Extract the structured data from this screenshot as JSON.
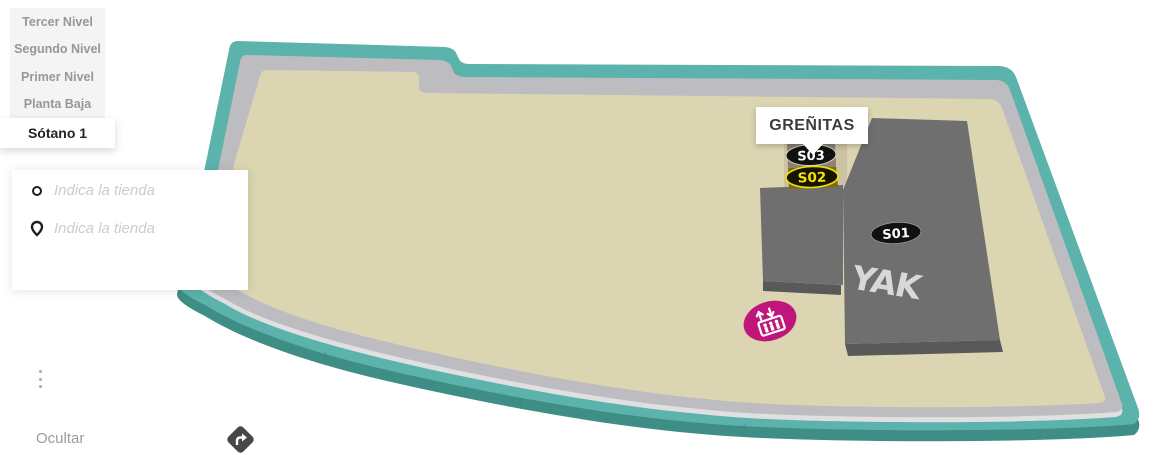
{
  "levels": {
    "items": [
      {
        "label": "Tercer Nivel"
      },
      {
        "label": "Segundo Nivel"
      },
      {
        "label": "Primer Nivel"
      },
      {
        "label": "Planta Baja"
      }
    ],
    "selected": {
      "label": "Sótano 1"
    }
  },
  "legend": {
    "origin_placeholder": "Indica la tienda",
    "destination_placeholder": "Indica la tienda",
    "hide_label": "Ocultar"
  },
  "map": {
    "bubble_label": "GREÑITAS",
    "stores": {
      "s01": {
        "id": "S01",
        "logo": "YAK"
      },
      "s02": {
        "id": "S02"
      },
      "s03": {
        "id": "S03"
      }
    },
    "icons": {
      "elevator": "elevator-icon",
      "directions": "directions-arrow-icon"
    },
    "colors": {
      "outline": "#5CB3AC",
      "outline_side": "#3E8E86",
      "walkway": "#BDBDC1",
      "walkway_side": "#E0E0E3",
      "floor": "#DBD5B1",
      "block": "#6F6F6F",
      "block_side": "#595959",
      "unit_s03": "#8C8170",
      "unit_s02": "#7E6B13",
      "unit_backing": "#CDC2A3",
      "badge_black": "#111111",
      "badge_yellow": "#F6E400",
      "elevator": "#C0157B"
    }
  }
}
